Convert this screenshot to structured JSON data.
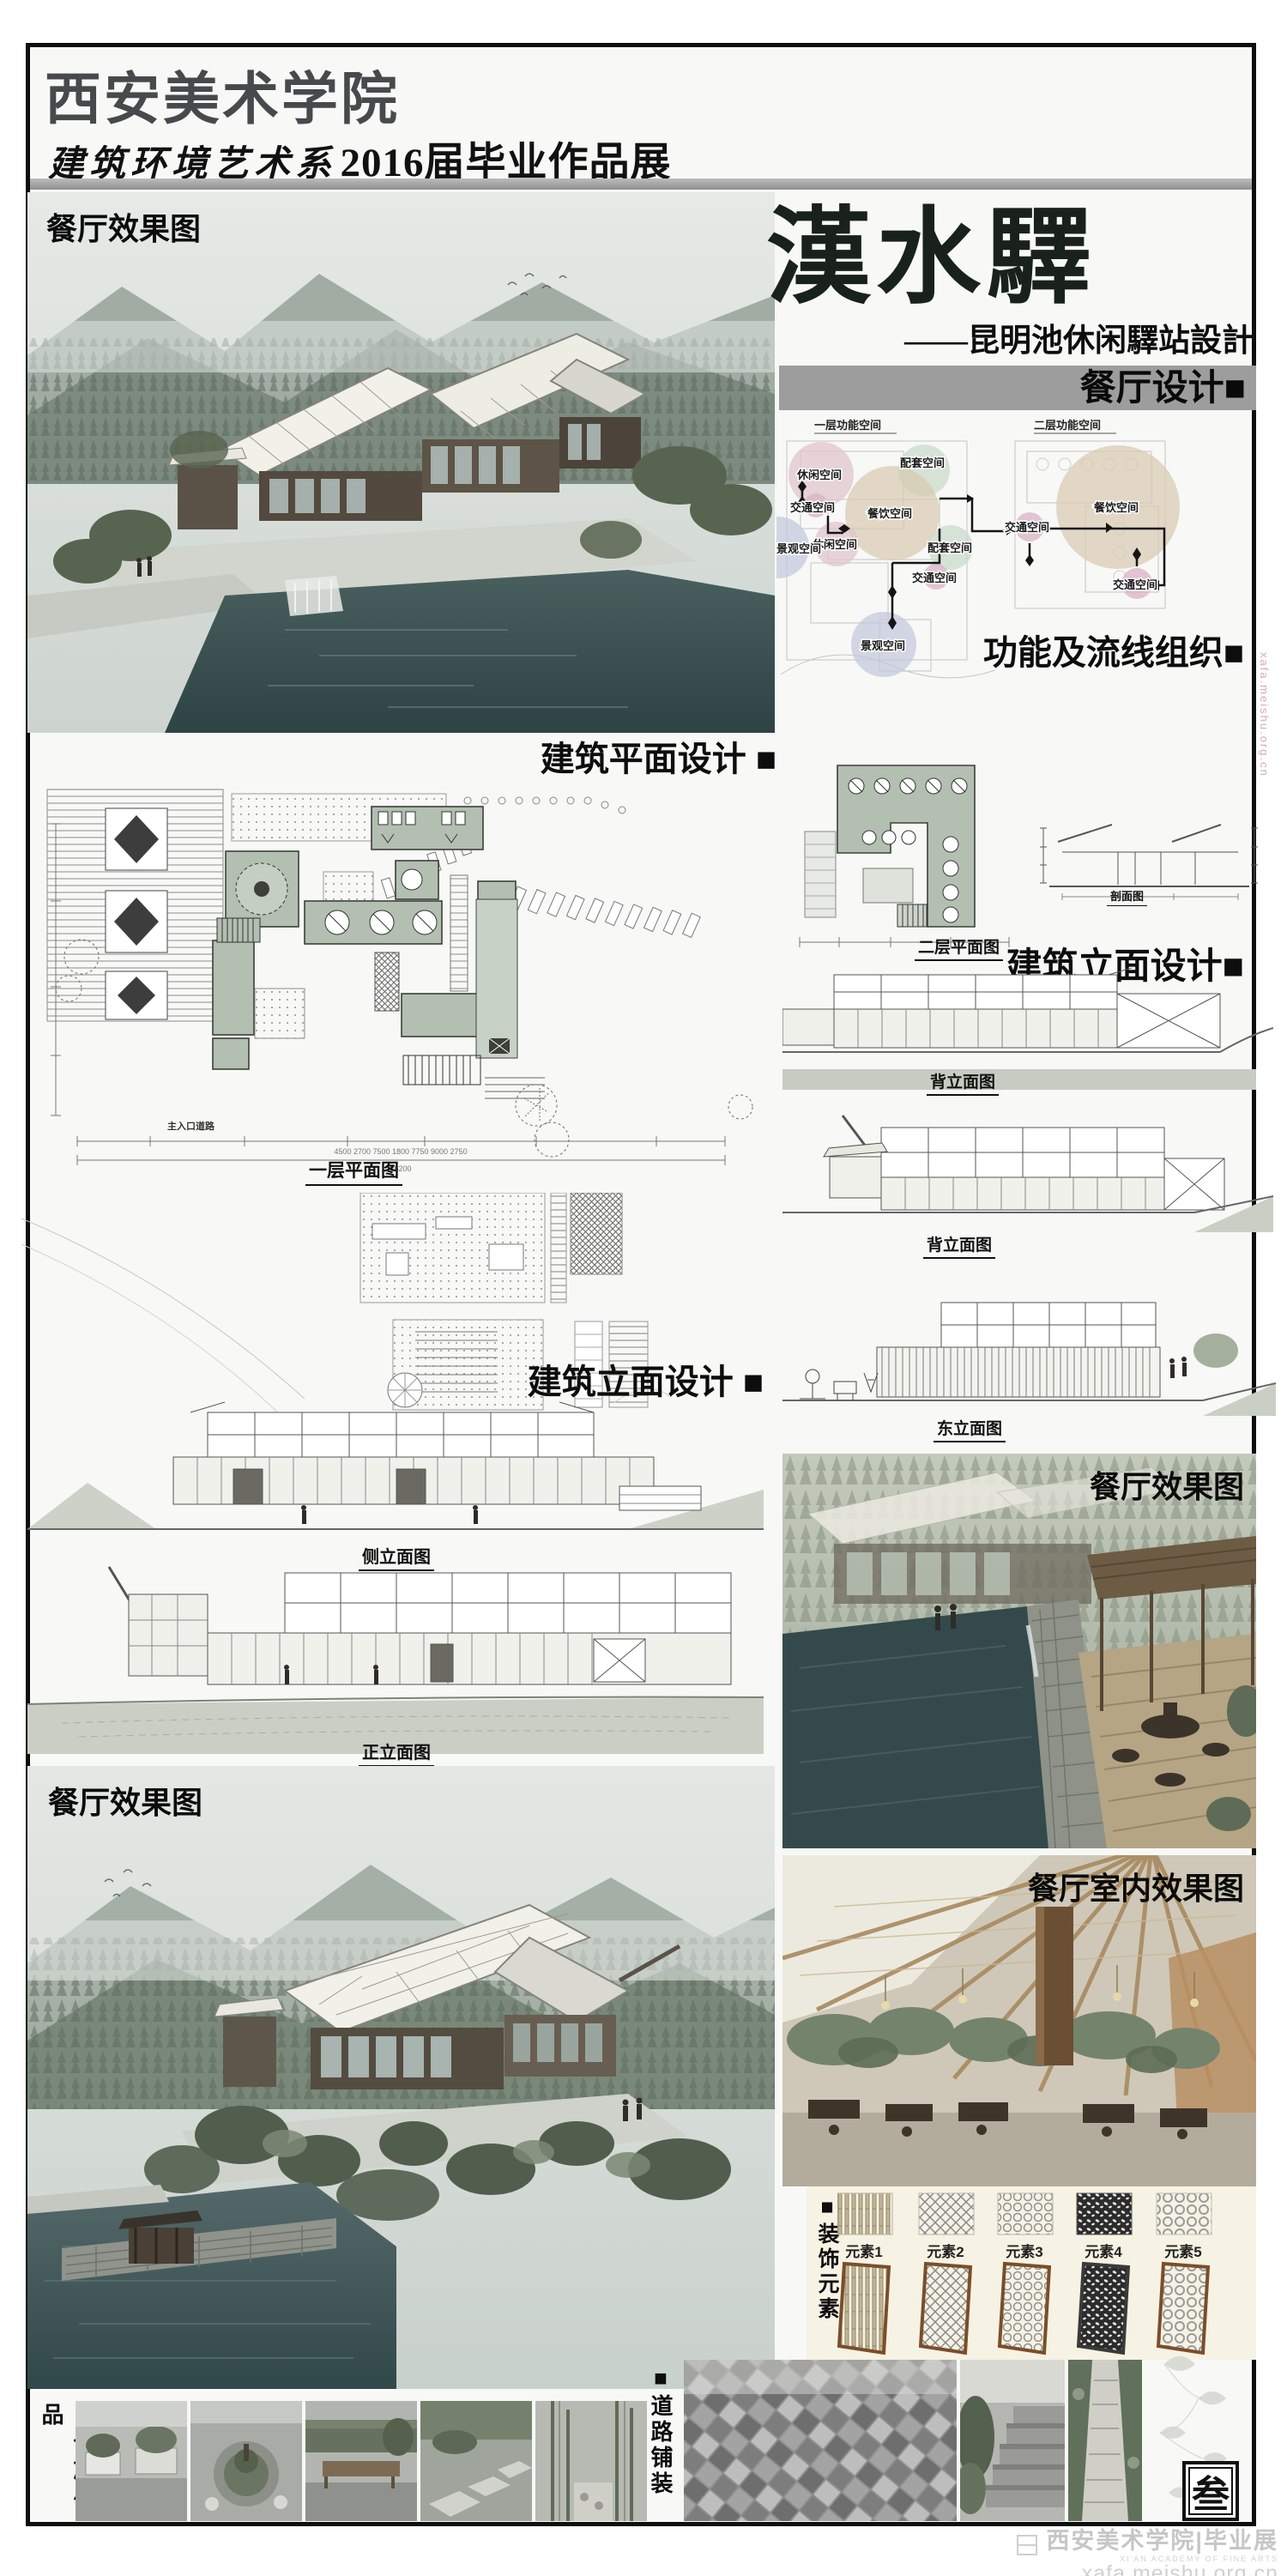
{
  "header": {
    "school": "西安美术学院",
    "dept": "建筑环境艺术系",
    "expo": "2016届毕业作品展"
  },
  "hero": {
    "label": "餐厅效果图"
  },
  "title_block": {
    "title": "漢水驛",
    "subtitle": "——昆明池休闲驛站設計",
    "bar_label": "餐厅设计■"
  },
  "colors": {
    "bar_gray": "#9d9d9d",
    "title_green": "#18221b",
    "bubble_pink": "#dfc3ca",
    "bubble_tan": "#d8cab0",
    "bubble_green": "#c8dbcb",
    "bubble_lavender": "#c3c7dd",
    "bubble_magenta": "#d9aec4",
    "plan_fill": "#b3bfb1",
    "ground_green": "#c9cfc4"
  },
  "function_diagram": {
    "left_header": "一层功能空间",
    "right_header": "二层功能空间",
    "caption": "功能及流线组织■",
    "bubbles": [
      {
        "label": "休闲空间"
      },
      {
        "label": "交通空间"
      },
      {
        "label": "配套空间"
      },
      {
        "label": "餐饮空间"
      },
      {
        "label": "休闲空间"
      },
      {
        "label": "配套空间"
      },
      {
        "label": "交通空间"
      },
      {
        "label": "景观空间"
      },
      {
        "label": "景观空间"
      },
      {
        "label": "交通空间"
      },
      {
        "label": "餐饮空间"
      },
      {
        "label": "交通空间"
      }
    ]
  },
  "plan_design": {
    "section_label": "建筑平面设计 ■",
    "plan_caption": "一层平面图",
    "entry_label": "主入口道路",
    "dim_string": "4500    2700    7500    1800    7750    9000    2750",
    "dim_total": "36200"
  },
  "floor2": {
    "caption": "二层平面图",
    "section_caption": "剖面图"
  },
  "elevation_right": {
    "section_label": "建筑立面设计■",
    "captions": [
      "背立面图",
      "背立面图",
      "东立面图"
    ]
  },
  "elevation_left": {
    "section_label": "建筑立面设计 ■",
    "captions": [
      "侧立面图",
      "正立面图"
    ]
  },
  "render_right": {
    "label": "餐厅效果图"
  },
  "render_interior": {
    "label": "餐厅室内效果图"
  },
  "render_bottom": {
    "label": "餐厅效果图"
  },
  "decor": {
    "vertical_label": "■装饰元素",
    "items": [
      "元素1",
      "元素2",
      "元素3",
      "元素4",
      "元素5"
    ]
  },
  "facilities": {
    "vertical_label": "■设施小品"
  },
  "paving": {
    "vertical_label": "■道路铺装"
  },
  "seal": {
    "char": "叁"
  },
  "watermark": {
    "brand": "西安美术学院|毕业展",
    "sub": "XI'AN ACADEMY OF FINE ARTS",
    "url": "xafa.meishu.org.cn",
    "side": "xafa.meishu.org.cn"
  }
}
